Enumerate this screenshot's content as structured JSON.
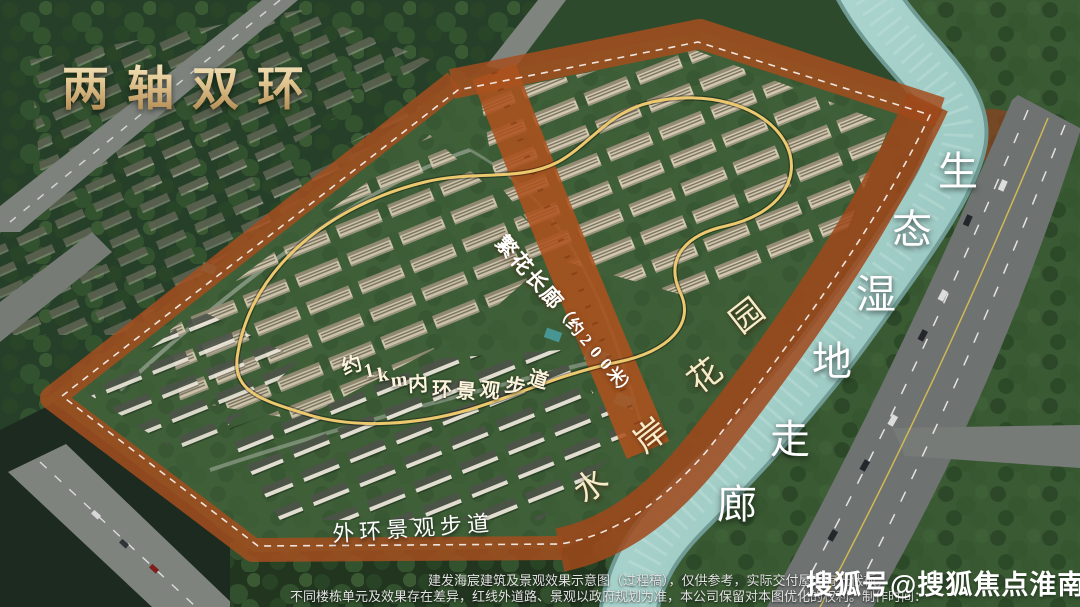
{
  "title": {
    "text": "两轴双环"
  },
  "labels": {
    "corridor": {
      "text": "繁花长廊（约200米）"
    },
    "inner_ring": {
      "text": "约1km内环景观步道"
    },
    "outer_ring": {
      "text": "外环景观步道"
    },
    "waterfront": {
      "text": "水岸花园"
    },
    "wetland": {
      "text": "生态湿地走廊"
    }
  },
  "disclaimer": {
    "line1": "建发海宸建筑及景观效果示意图（过程稿），仅供参考，实际交付屋面有光伏板，",
    "line2": "不同楼栋单元及效果存在差异，红线外道路、景观以政府规划为准，本公司保留对本图优化的权利。制作时间："
  },
  "watermark": {
    "text": "搜狐号@搜狐焦点淮南站"
  },
  "colors": {
    "title_gold": "#e3c893",
    "band_rust": "#a54e1e",
    "ring_gold": "#ecc96f",
    "river": "#a7d0cb",
    "label_white": "#ffffff",
    "label_cream": "#f7ecc9"
  }
}
